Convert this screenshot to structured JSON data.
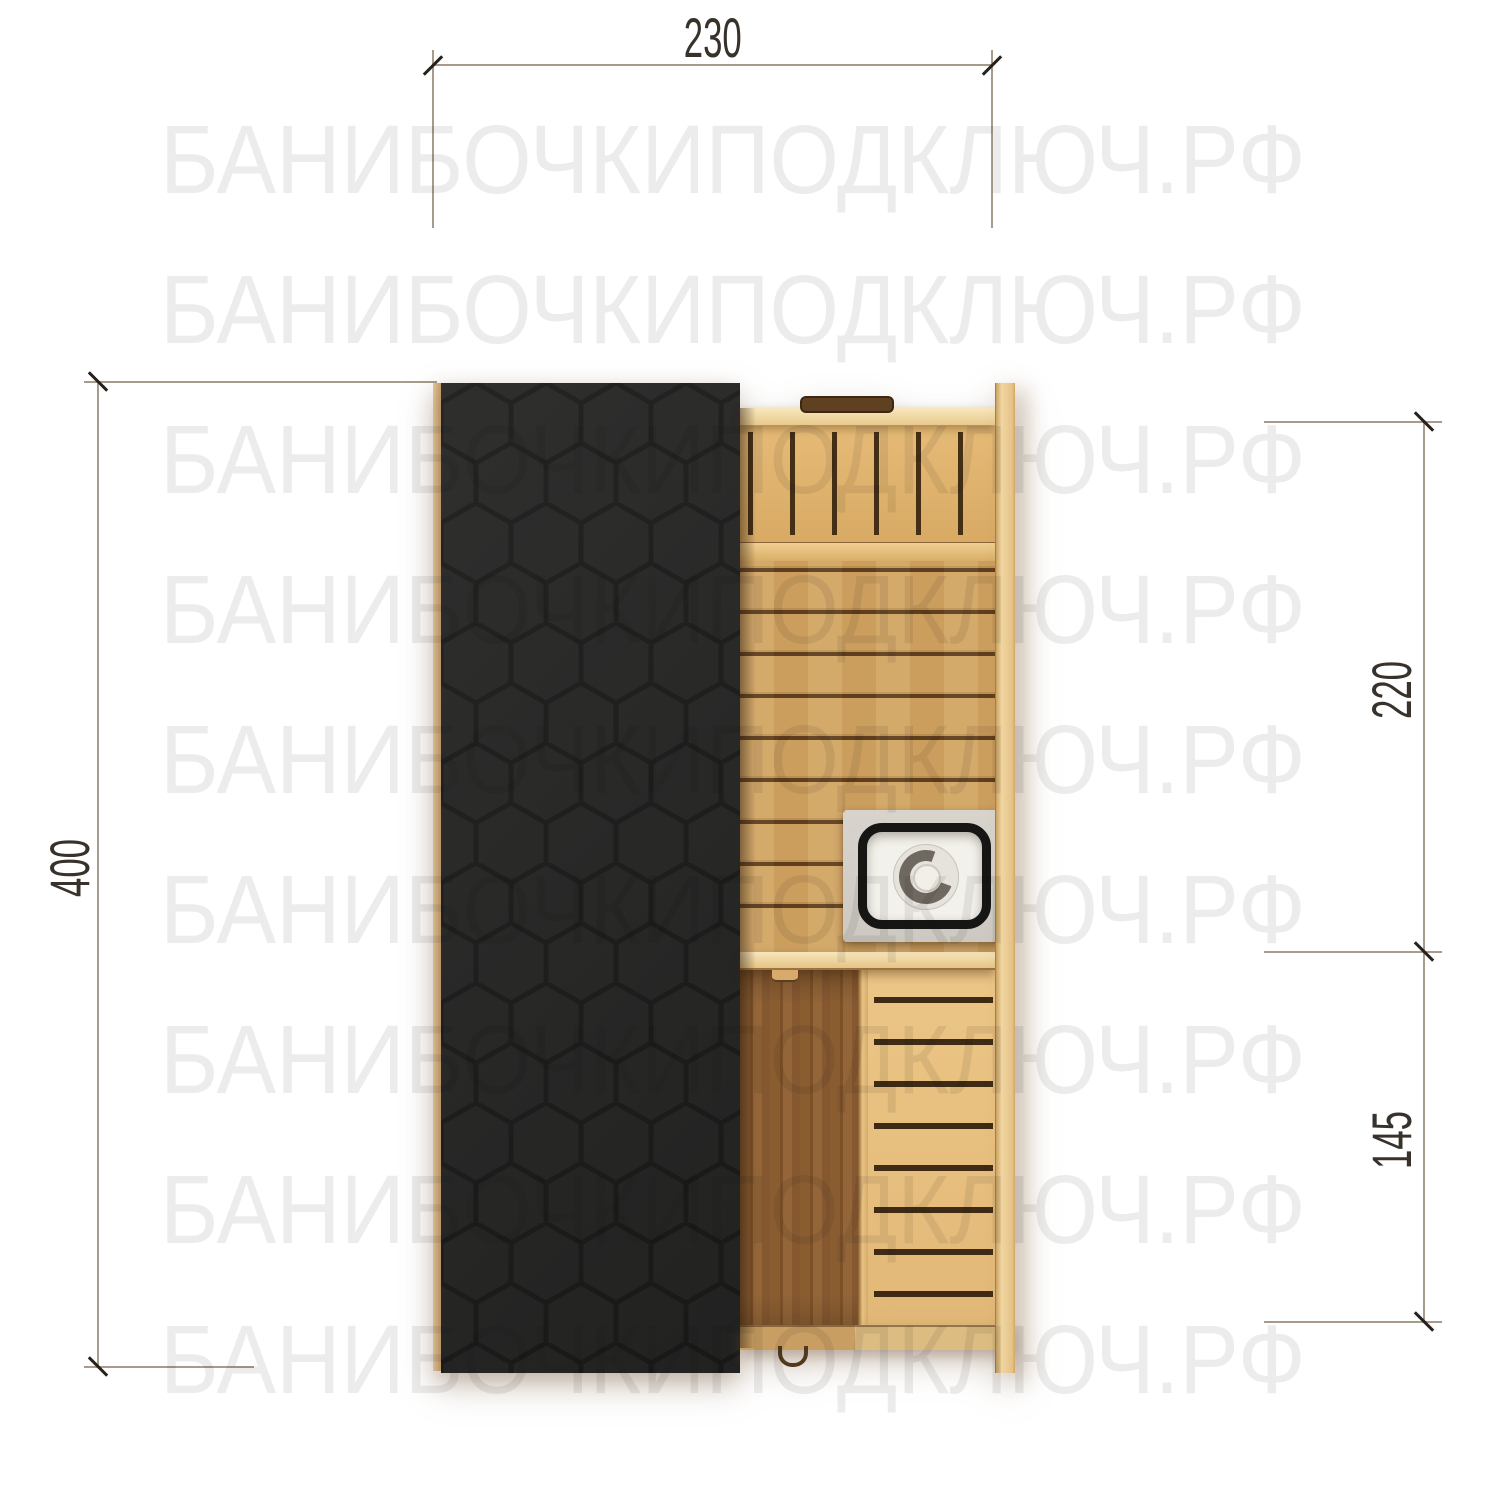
{
  "watermark": {
    "text": "БАНИБОЧКИПОДКЛЮЧ.РФ",
    "left": 160,
    "rows_y": [
      111,
      261,
      411,
      561,
      711,
      861,
      1011,
      1161,
      1311
    ]
  },
  "dimensions": {
    "top": {
      "value": "230"
    },
    "left": {
      "value": "400"
    },
    "right_upper": {
      "value": "220"
    },
    "right_lower": {
      "value": "145"
    }
  },
  "plan": {
    "roof_covering": "hexagon-shingles",
    "rooms": [
      "steam-room",
      "entrance-room"
    ],
    "fixtures": [
      "bench",
      "stove",
      "partition",
      "door-handle"
    ]
  },
  "palette": {
    "bg": "#ffffff",
    "wm_color": "#ececec",
    "dim_line": "#a89b8b",
    "dim_tick": "#27211b",
    "dim_text": "#38322b",
    "roof_fill": "#282827",
    "roof_stroke": "#1d1d1c",
    "wall_wood": "#eccf9b",
    "slat_gap": "#442e14",
    "floor_wood": "#d2a563",
    "floor_seam": "#5e3e1e",
    "walnut": "#8a5d31",
    "hall_bench": "#e2b877",
    "hall_gap": "#3f2b13",
    "bottom_wall_l": "#c89e63",
    "bottom_wall_r": "#ddbc82",
    "handle_wood": "#5f4122",
    "stove_metal": "#cdc9c2",
    "stove_rim": "#161615",
    "stove_inner": "#f3f1eb",
    "stove_ring": "#6e6860"
  }
}
